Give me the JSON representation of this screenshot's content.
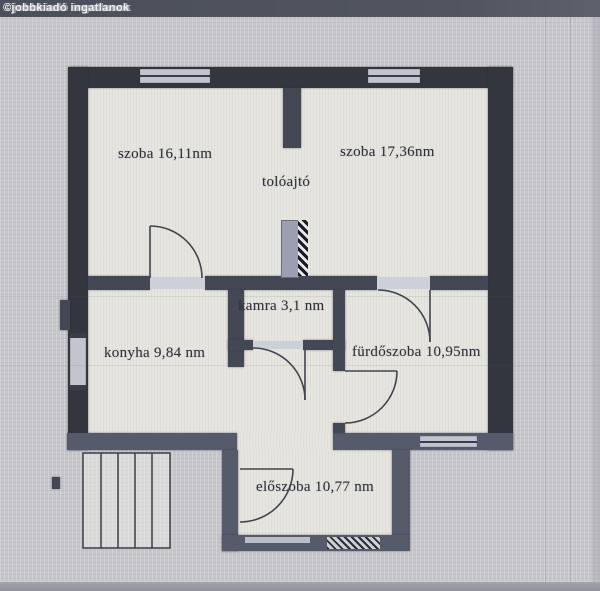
{
  "image_type": "floor_plan_photo",
  "watermark": "©jobbkiadó ingatlanok",
  "labels": {
    "szoba1": "szoba 16,11nm",
    "szoba2": "szoba 17,36nm",
    "toloajto": "tolóajtó",
    "kamra": "kamra 3,1 nm",
    "konyha": "konyha 9,84 nm",
    "furdoszoba": "fürdőszoba 10,95nm",
    "eloszoba": "előszoba 10,77 nm"
  },
  "rooms": [
    {
      "name": "szoba",
      "label": "szoba 16,11nm",
      "area_nm": 16.11
    },
    {
      "name": "szoba",
      "label": "szoba 17,36nm",
      "area_nm": 17.36
    },
    {
      "name": "kamra",
      "label": "kamra 3,1 nm",
      "area_nm": 3.1
    },
    {
      "name": "konyha",
      "label": "konyha 9,84 nm",
      "area_nm": 9.84
    },
    {
      "name": "fürdőszoba",
      "label": "fürdőszoba 10,95nm",
      "area_nm": 10.95
    },
    {
      "name": "előszoba",
      "label": "előszoba 10,77 nm",
      "area_nm": 10.77
    }
  ],
  "annotations": [
    {
      "name": "tolóajtó",
      "meaning": "sliding door"
    }
  ],
  "symbols": [
    "window",
    "door-swing-arc",
    "sliding-door-hatch",
    "staircase",
    "entrance-door-hatch"
  ],
  "colors": {
    "background": "#c7c7cb",
    "room_fill": "#e7e5df",
    "wall_dark": "#33363f",
    "wall_mid": "#434854",
    "wall_light": "#565b6c",
    "threshold": "#ccd0d8",
    "watermark_band": "#4a4f5b",
    "label_text": "#2e313d"
  }
}
